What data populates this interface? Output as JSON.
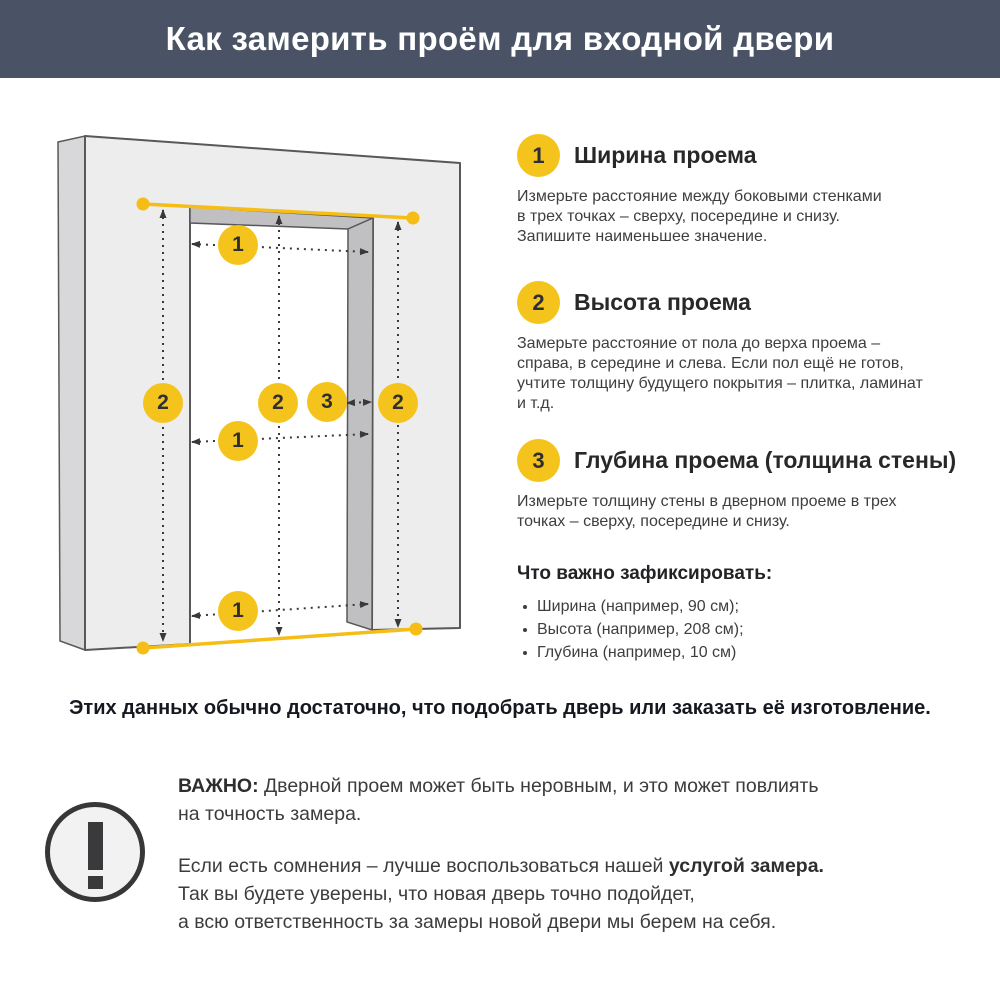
{
  "header": {
    "title": "Как замерить проём для входной двери"
  },
  "diagram": {
    "description": "3D wall with doorway opening and measurement arrows",
    "width_label": "1",
    "height_label": "2",
    "depth_label": "3"
  },
  "steps": [
    {
      "num": "1",
      "title": "Ширина проема",
      "body": "Измерьте расстояние между боковыми стенками\nв трех точках – сверху, посередине и снизу.\nЗапишите наименьшее значение."
    },
    {
      "num": "2",
      "title": "Высота проема",
      "body": "Замерьте расстояние от пола до верха проема –\nсправа, в середине и слева. Если пол ещё не готов,\nучтите толщину будущего покрытия – плитка, ламинат\nи т.д."
    },
    {
      "num": "3",
      "title": "Глубина проема (толщина стены)",
      "body": "Измерьте толщину стены в дверном проеме в трех\nточках – сверху, посередине и снизу."
    }
  ],
  "checklist": {
    "title": "Что важно зафиксировать:",
    "items": [
      "Ширина (например, 90 см);",
      "Высота (например, 208 см);",
      "Глубина (например, 10 см)"
    ]
  },
  "summary": "Этих данных обычно достаточно, что подобрать дверь или заказать её изготовление.",
  "important": {
    "label": "ВАЖНО:",
    "p1_rest": " Дверной проем может быть неровным, и это может повлиять\nна точность замера.",
    "p2_pre": "Если есть сомнения – лучше воспользоваться нашей ",
    "p2_bold": "услугой замера.",
    "p2_rest": "\nТак вы будете уверены, что новая дверь точно подойдет,\nа всю ответственность за замеры новой двери мы берем на себя."
  },
  "colors": {
    "accent_yellow": "#F5C41C",
    "header_bg": "#4A5365",
    "wall_face": "#EDEDEE",
    "wall_inner": "#C0C0C2",
    "outline": "#58585A",
    "text_dark": "#3E3E40"
  }
}
